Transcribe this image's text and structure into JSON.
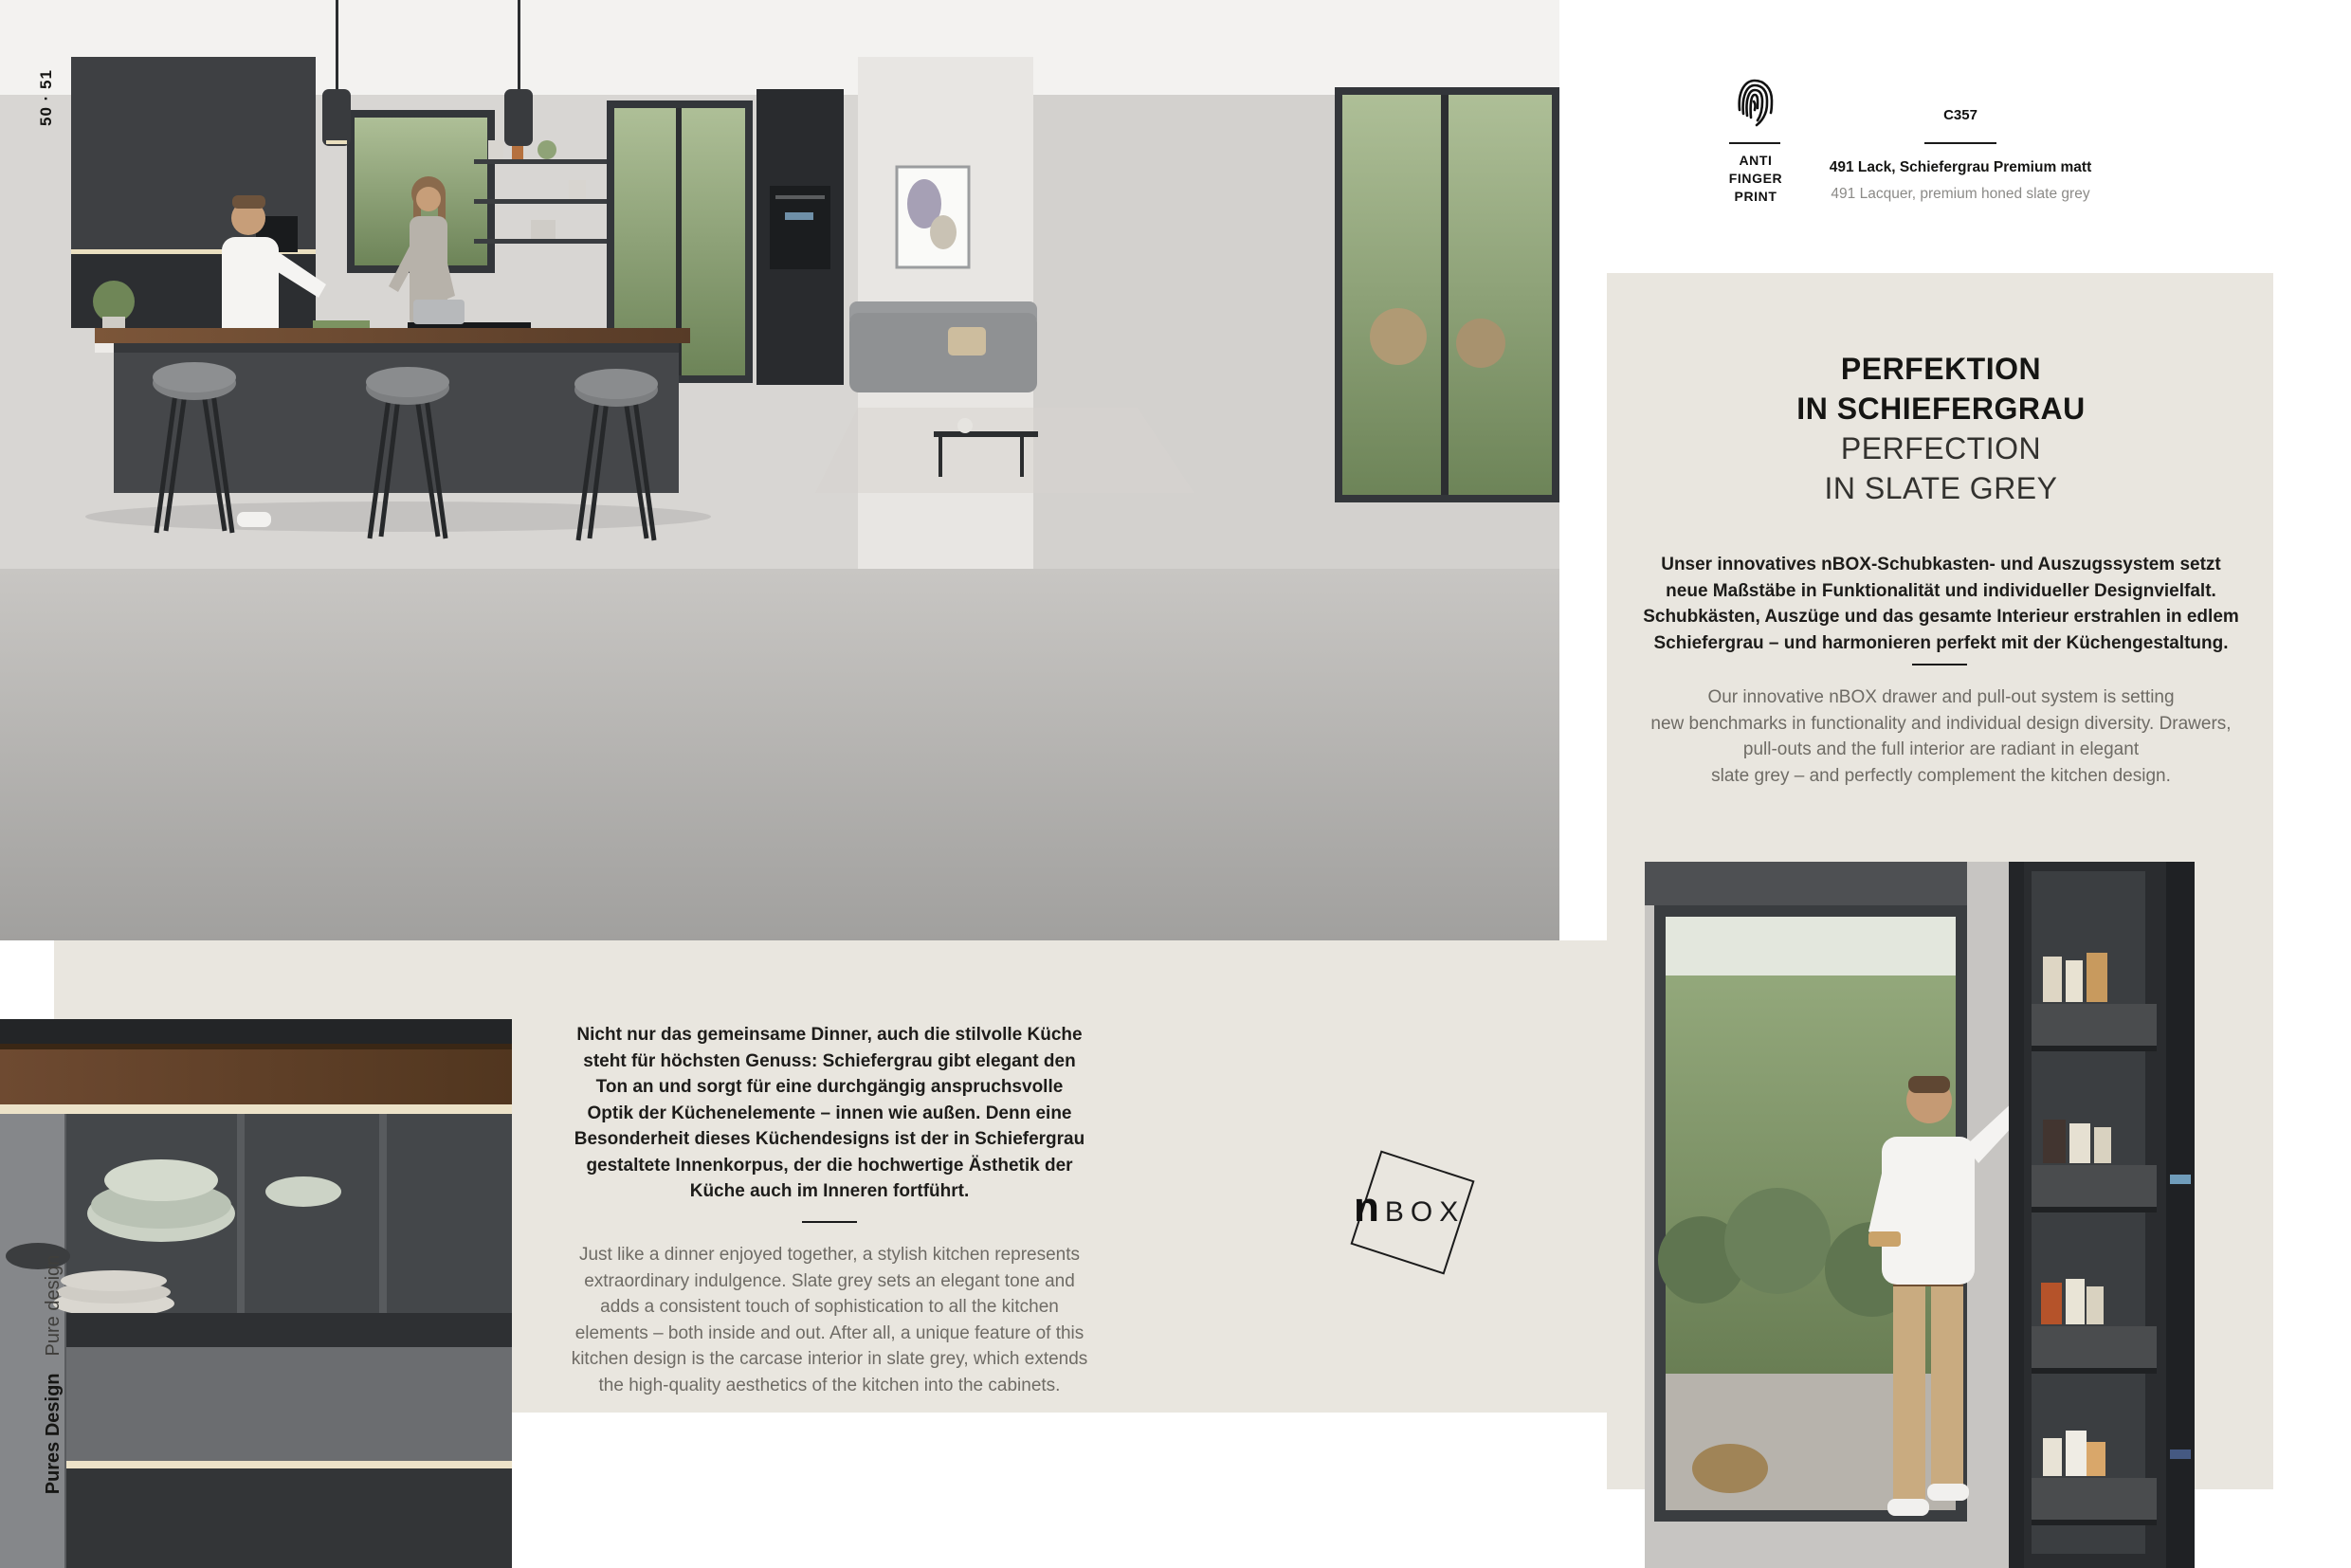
{
  "page": {
    "spread_number": "50 · 51",
    "background": "#ffffff",
    "panel_beige": "#e9e6df"
  },
  "header": {
    "antifingerprint": {
      "icon": "fingerprint-icon",
      "label_lines": [
        "ANTI",
        "FINGER",
        "PRINT"
      ]
    },
    "finish": {
      "code": "C357",
      "de": "491 Lack, Schiefergrau Premium matt",
      "en": "491 Lacquer, premium honed slate grey"
    }
  },
  "right_panel": {
    "title_de_lines": [
      "PERFEKTION",
      "IN SCHIEFERGRAU"
    ],
    "title_en_lines": [
      "PERFECTION",
      "IN SLATE GREY"
    ],
    "body_de_lines": [
      "Unser innovatives nBOX-Schubkasten- und Auszugssystem setzt",
      "neue Maßstäbe in Funktionalität und individueller Designvielfalt.",
      "Schubkästen, Auszüge und das gesamte Interieur erstrahlen in edlem",
      "Schiefergrau – und harmonieren perfekt mit der Küchengestaltung."
    ],
    "body_en_lines": [
      "Our innovative nBOX drawer and pull-out system is setting",
      "new benchmarks in functionality and individual design diversity. Drawers,",
      "pull-outs and the full interior are radiant in elegant",
      "slate grey – and perfectly complement the kitchen design."
    ]
  },
  "mid_panel": {
    "body_de_lines": [
      "Nicht nur das gemeinsame Dinner, auch die stilvolle Küche",
      "steht für höchsten Genuss: Schiefergrau gibt elegant den",
      "Ton an und sorgt für eine durchgängig anspruchsvolle",
      "Optik der Küchenelemente – innen wie außen. Denn eine",
      "Besonderheit dieses Küchendesigns ist der in Schiefergrau",
      "gestaltete Innenkorpus, der die hochwertige Ästhetik der",
      "Küche auch im Inneren fortführt."
    ],
    "body_en_lines": [
      "Just like a dinner enjoyed together, a stylish kitchen represents",
      "extraordinary indulgence. Slate grey sets an elegant tone and",
      "adds a consistent touch of sophistication to all the kitchen",
      "elements – both inside and out. After all, a unique feature of this",
      "kitchen design is the carcase interior in slate grey, which extends",
      "the high-quality aesthetics of the kitchen into the cabinets."
    ]
  },
  "nbox_logo": {
    "bold": "n",
    "light": "BOX"
  },
  "side_label": {
    "de": "Pures Design",
    "en": "Pure design"
  },
  "colors": {
    "body_text": "#1a1a1a",
    "muted_text": "#6e6b65"
  }
}
